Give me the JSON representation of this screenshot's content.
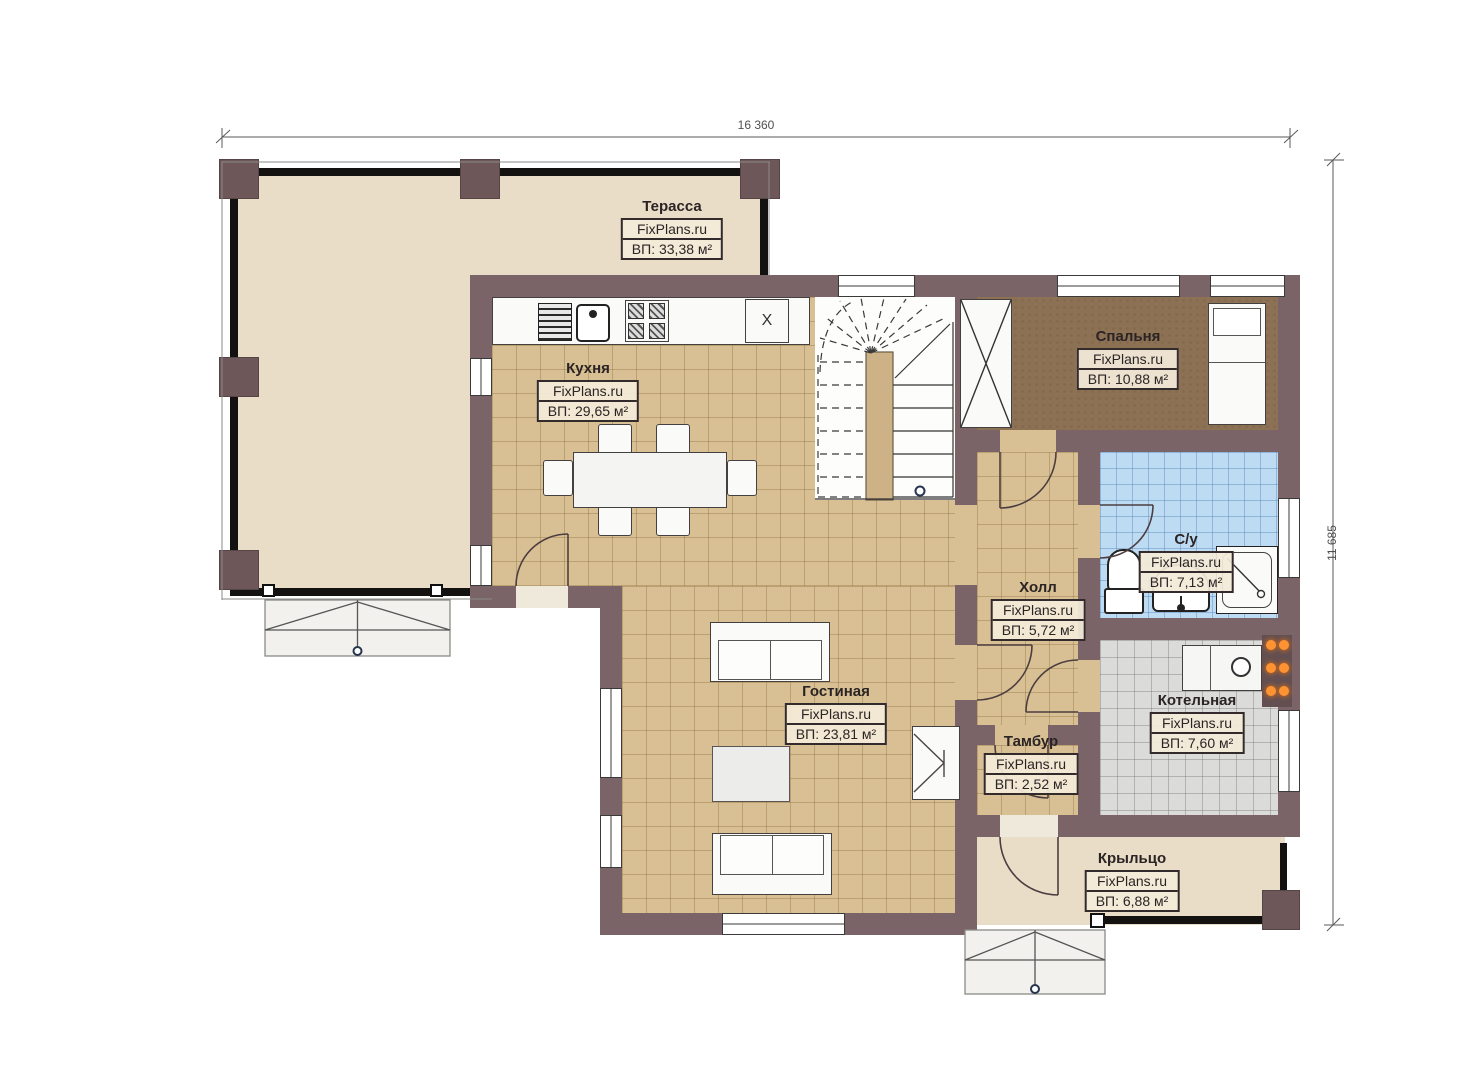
{
  "plan": {
    "brand": "FixPlans.ru",
    "floor": "first-floor-plan"
  },
  "dimensions": {
    "top": "16 360",
    "right": "11 685"
  },
  "rooms": [
    {
      "key": "terrace",
      "name": "Терасса",
      "brand": "FixPlans.ru",
      "area": "ВП: 33,38 м²"
    },
    {
      "key": "kitchen",
      "name": "Кухня",
      "brand": "FixPlans.ru",
      "area": "ВП: 29,65 м²"
    },
    {
      "key": "bedroom",
      "name": "Спальня",
      "brand": "FixPlans.ru",
      "area": "ВП: 10,88 м²"
    },
    {
      "key": "bathroom",
      "name": "С/у",
      "brand": "FixPlans.ru",
      "area": "ВП: 7,13 м²"
    },
    {
      "key": "hall",
      "name": "Холл",
      "brand": "FixPlans.ru",
      "area": "ВП: 5,72 м²"
    },
    {
      "key": "living",
      "name": "Гостиная",
      "brand": "FixPlans.ru",
      "area": "ВП: 23,81 м²"
    },
    {
      "key": "vestibule",
      "name": "Тамбур",
      "brand": "FixPlans.ru",
      "area": "ВП: 2,52 м²"
    },
    {
      "key": "boiler",
      "name": "Котельная",
      "brand": "FixPlans.ru",
      "area": "ВП: 7,60 м²"
    },
    {
      "key": "porch",
      "name": "Крыльцо",
      "brand": "FixPlans.ru",
      "area": "ВП: 6,88 м²"
    }
  ],
  "annotations": {
    "cabinet_mark": "X"
  },
  "colors": {
    "wall": "#7b6467",
    "terrace_floor": "#e9ddc7",
    "tile_tan": "#d9c094",
    "bedroom_floor": "#8c7154",
    "tile_blue": "#bedbf4",
    "tile_gray": "#dbdbd9",
    "accent_orange": "#ff9333"
  }
}
